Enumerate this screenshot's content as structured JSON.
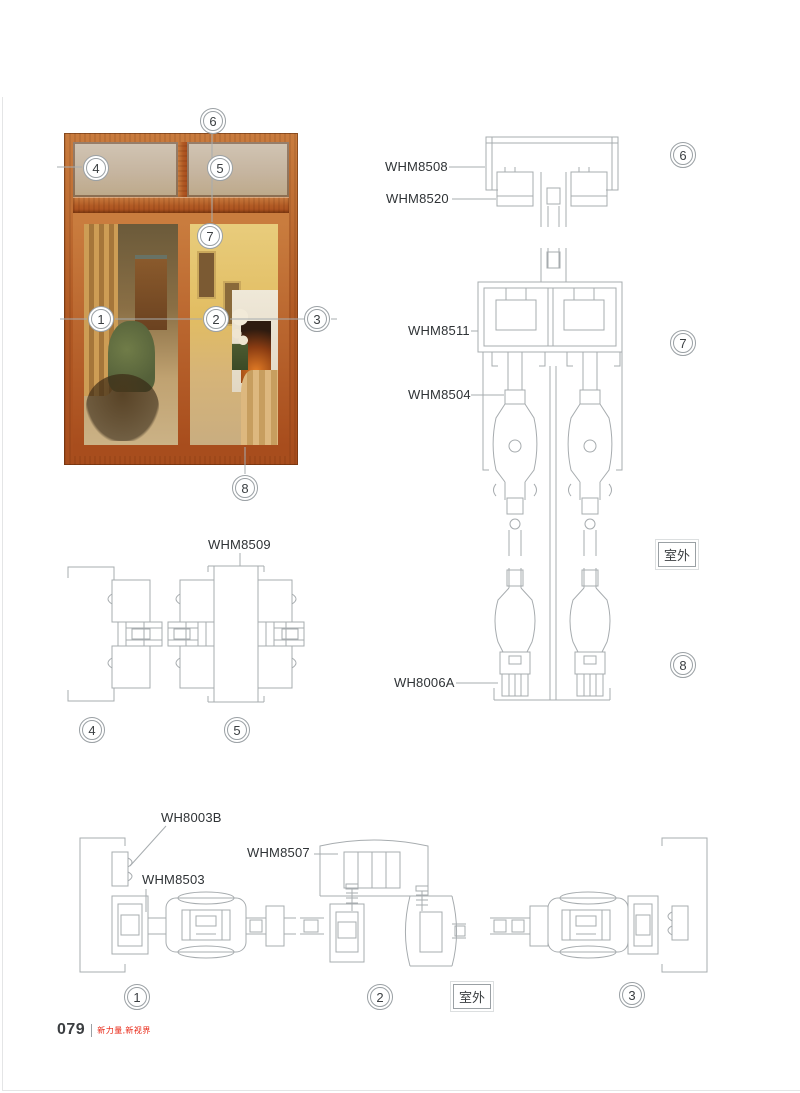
{
  "callouts": {
    "photo": [
      "1",
      "2",
      "3",
      "4",
      "5",
      "6",
      "7",
      "8"
    ],
    "mid": [
      "4",
      "5"
    ],
    "right": [
      "6",
      "7",
      "8"
    ],
    "bottom": [
      "1",
      "2",
      "3"
    ]
  },
  "labels": {
    "l8508": "WHM8508",
    "l8520": "WHM8520",
    "l8511": "WHM8511",
    "l8504": "WHM8504",
    "l8006a": "WH8006A",
    "l8509": "WHM8509",
    "l8003b": "WH8003B",
    "l8503": "WHM8503",
    "l8507": "WHM8507"
  },
  "outdoor": {
    "text": "室外"
  },
  "footer": {
    "page_number": "079",
    "slogan": "新力量,新视界"
  },
  "colors": {
    "accent_red": "#e8210f",
    "drawing_line": "#a7acaf",
    "wood": "#b15a24"
  }
}
